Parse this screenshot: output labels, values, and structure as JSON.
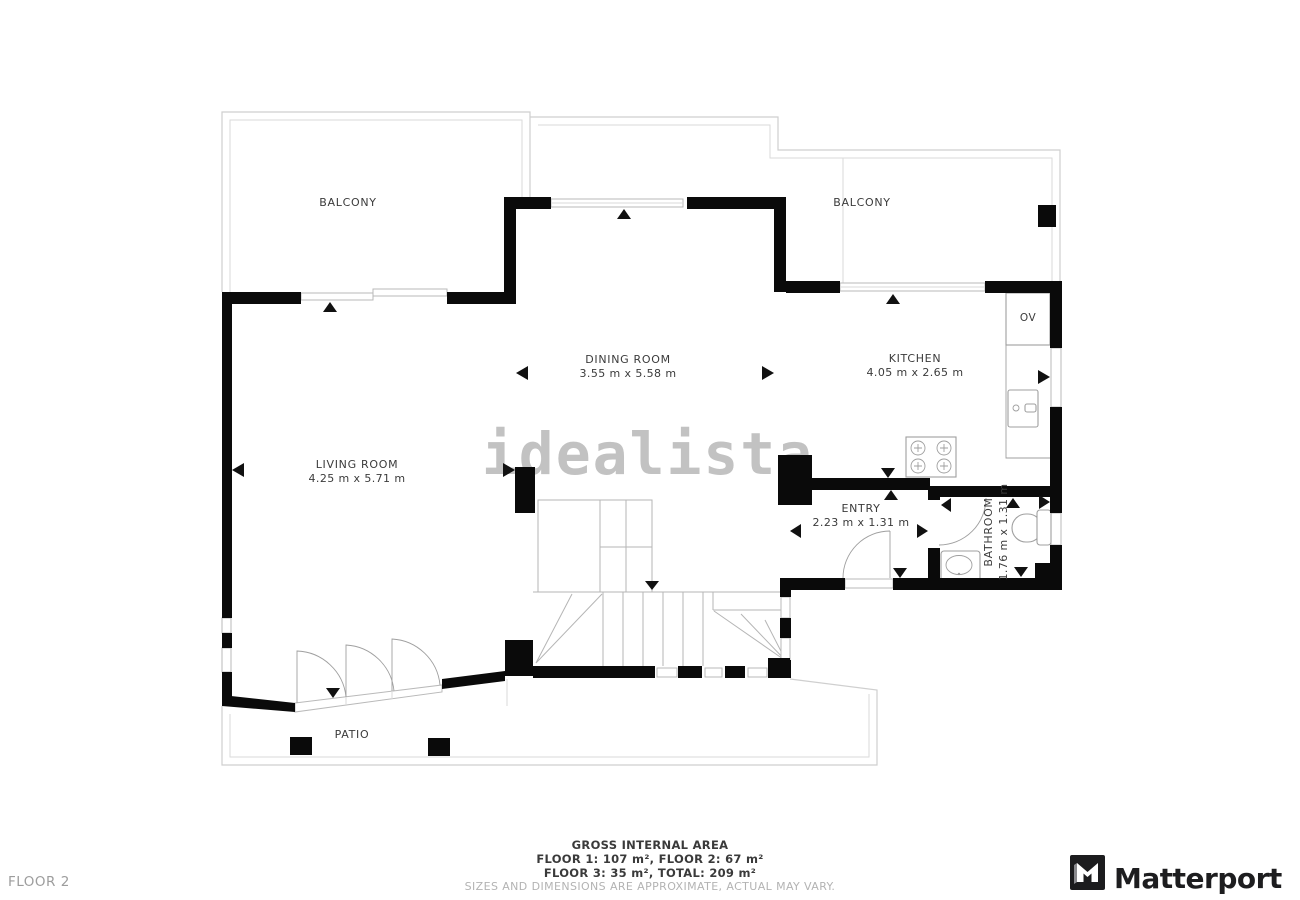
{
  "rooms": {
    "balcony_left": {
      "label": "BALCONY"
    },
    "balcony_right": {
      "label": "BALCONY"
    },
    "dining_room": {
      "label": "DINING ROOM",
      "dims": "3.55 m x 5.58 m"
    },
    "kitchen": {
      "label": "KITCHEN",
      "dims": "4.05 m x 2.65 m"
    },
    "living_room": {
      "label": "LIVING ROOM",
      "dims": "4.25 m x 5.71 m"
    },
    "entry": {
      "label": "ENTRY",
      "dims": "2.23 m x 1.31 m"
    },
    "bathroom": {
      "label": "BATHROOM",
      "dims": "1.76 m x 1.31 m"
    },
    "patio": {
      "label": "PATIO"
    },
    "oven_closet": {
      "label": "OV"
    }
  },
  "watermark": {
    "text": "idealista"
  },
  "footer": {
    "area_title": "GROSS INTERNAL AREA",
    "area_line1": "FLOOR 1: 107 m², FLOOR 2: 67 m²",
    "area_line2": "FLOOR 3: 35 m², TOTAL: 209 m²",
    "disclaimer": "SIZES AND DIMENSIONS ARE APPROXIMATE, ACTUAL MAY VARY.",
    "floor_label": "FLOOR 2",
    "brand": "Matterport"
  },
  "colors": {
    "wall": "#0a0a0a",
    "outline": "#cfcfcf",
    "label_text": "#3b3b3b",
    "muted_text": "#b3b3b3",
    "watermark": "#c2c2c2",
    "brand_text": "#1d1d1f"
  }
}
